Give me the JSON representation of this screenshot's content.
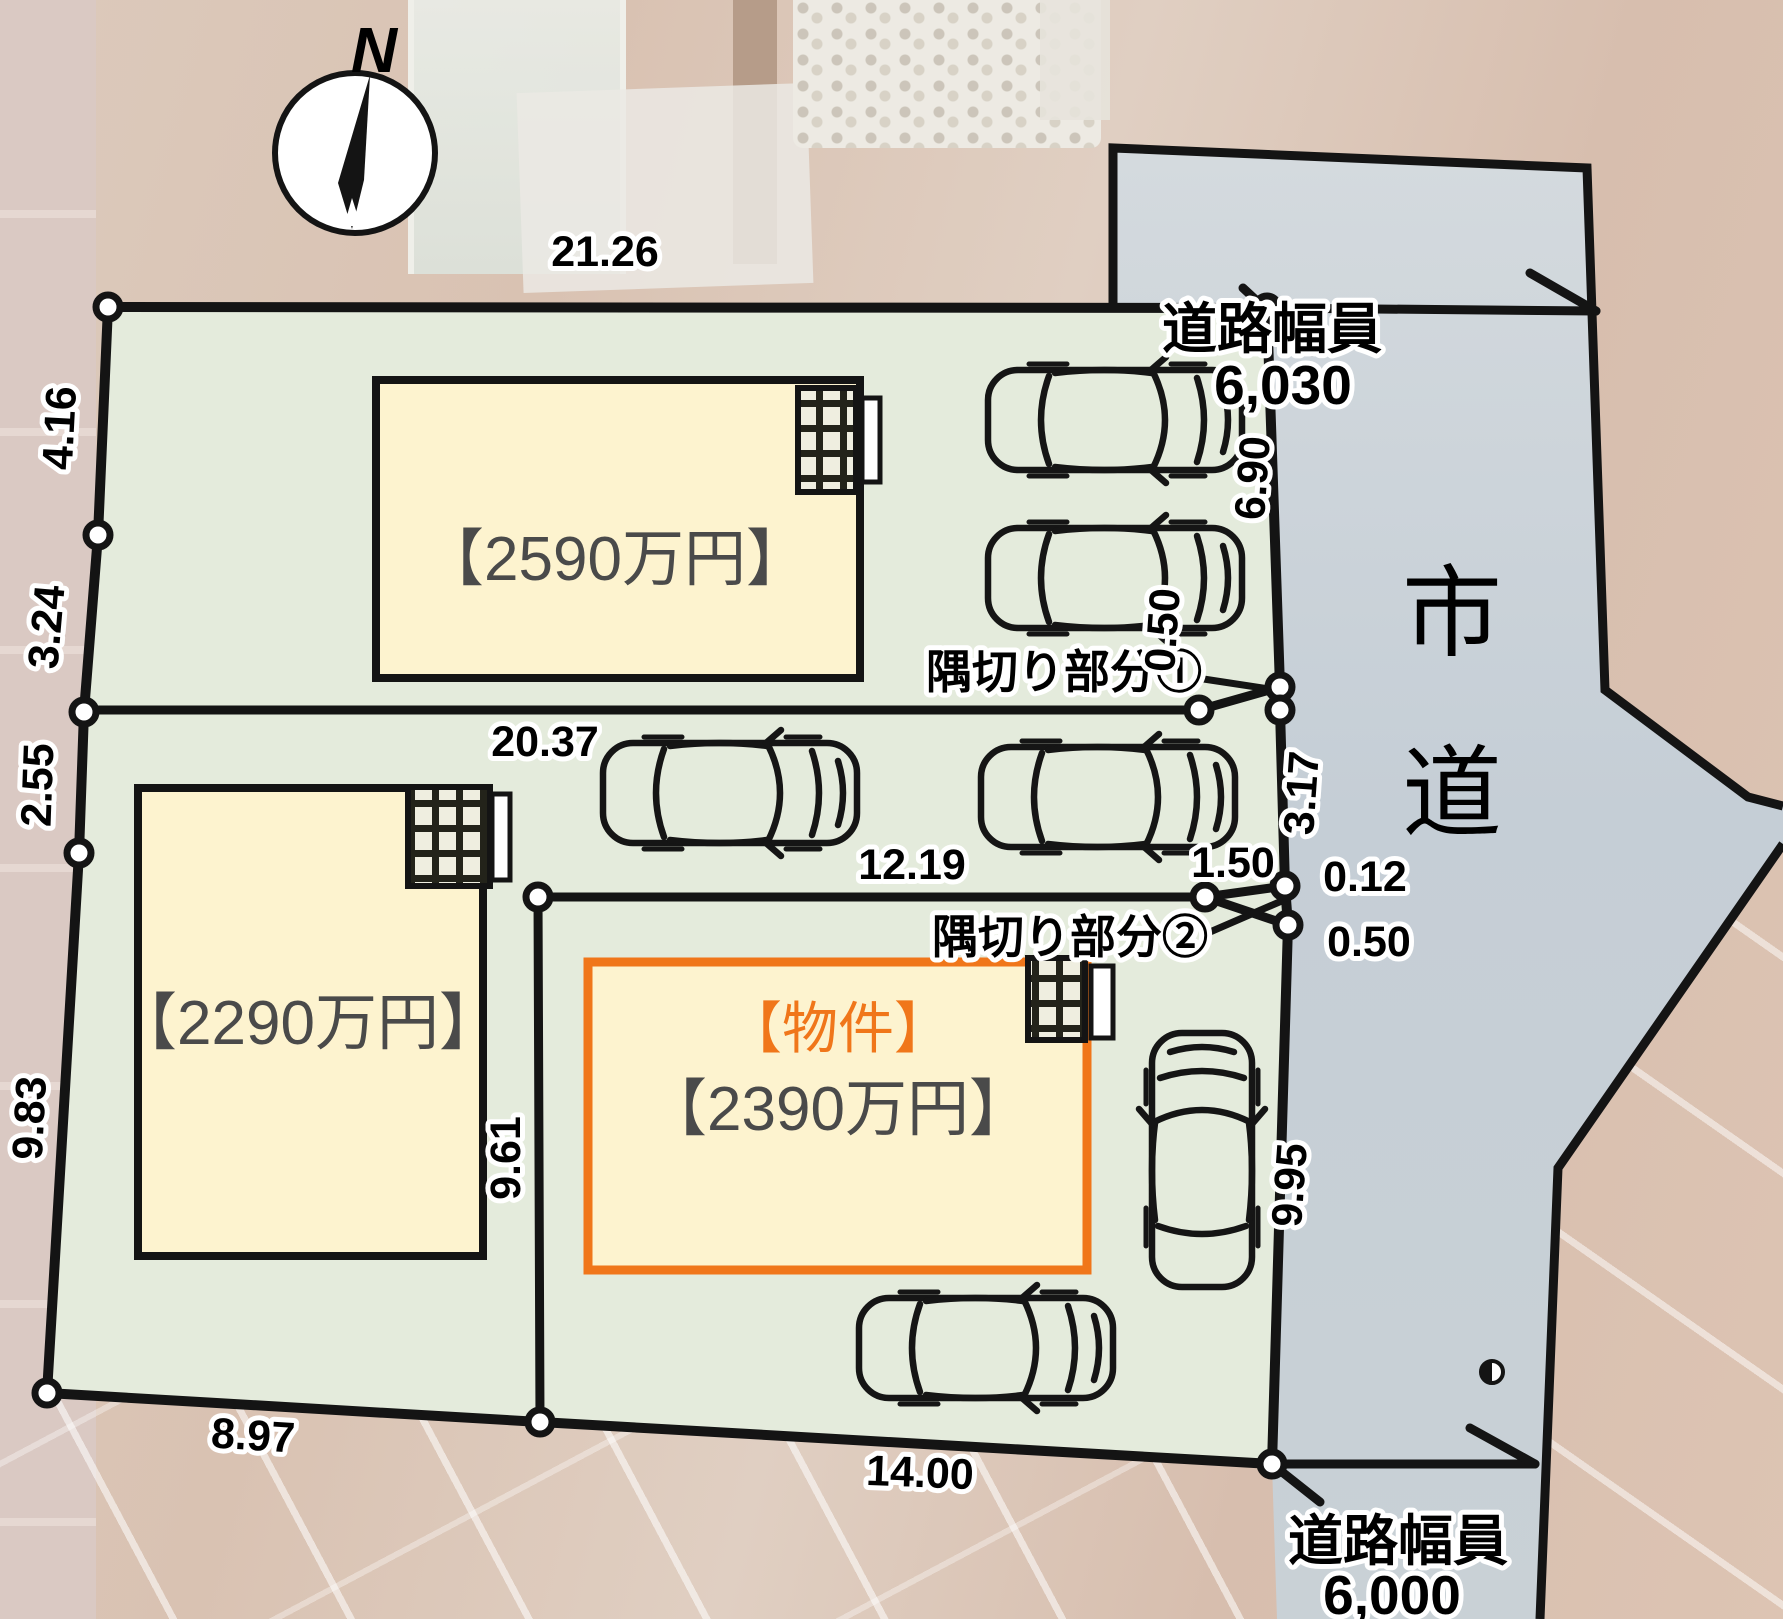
{
  "compass": {
    "north_label": "N"
  },
  "lots": [
    {
      "id": "lot1",
      "price": "【2590万円】"
    },
    {
      "id": "lot2",
      "price": "【2290万円】"
    },
    {
      "id": "lot3",
      "tag": "【物件】",
      "price": "【2390万円】"
    }
  ],
  "road": {
    "name_char_1": "市",
    "name_char_2": "道",
    "width_top_label": "道路幅員",
    "width_top_value": "6,030",
    "width_bottom_label": "道路幅員",
    "width_bottom_value": "6,000"
  },
  "corner_cuts": {
    "cut1_label": "隅切り部分①",
    "cut2_label": "隅切り部分②"
  },
  "dimensions": {
    "top_edge": "21.26",
    "left_1": "4.16",
    "left_2": "3.24",
    "left_3": "2.55",
    "left_4": "9.83",
    "bottom_1": "8.97",
    "bottom_2": "14.00",
    "right_1": "6.90",
    "right_cut1": "0.50",
    "right_2": "3.17",
    "cut2_1": "1.50",
    "cut2_2": "0.12",
    "cut2_3": "0.50",
    "right_3": "9.95",
    "lot1_south_edge": "20.37",
    "lot3_north_edge": "12.19",
    "lot3_west_edge": "9.61"
  },
  "colors": {
    "plot_fill": "#e4ebdc",
    "road_fill": "#c7d0d8",
    "building_fill": "#fdf3cf",
    "highlight_orange": "#f0761a",
    "price_text": "#4a4a4a",
    "line_black": "#141414"
  }
}
